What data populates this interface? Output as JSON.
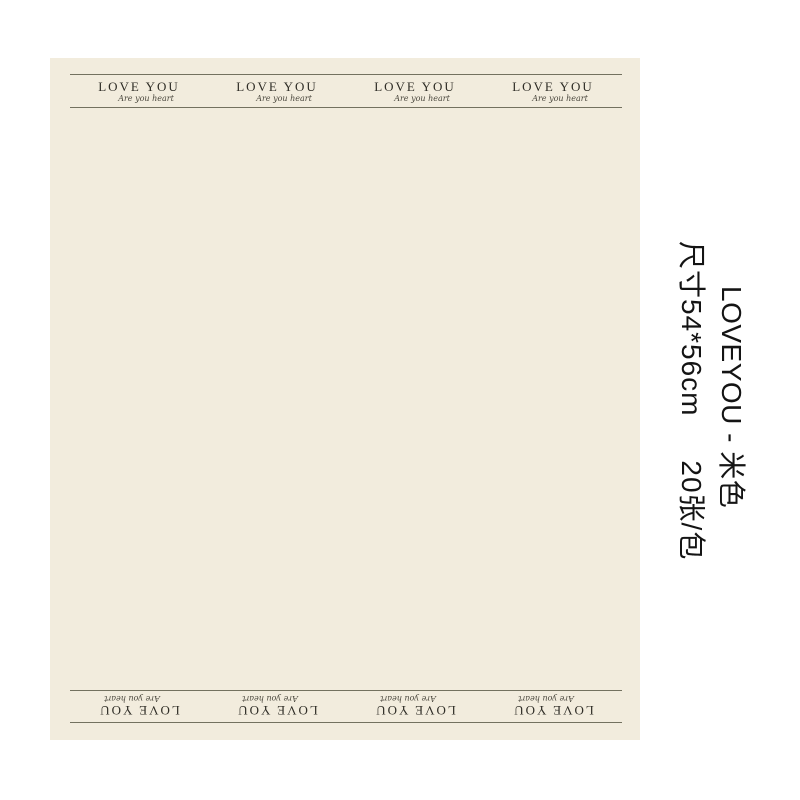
{
  "colors": {
    "paper": "#f2ecdd",
    "line": "#73715f",
    "logo-text": "#2f2d26",
    "script-text": "#4a473d",
    "caption-text": "#141414",
    "page-bg": "#ffffff"
  },
  "paper": {
    "logo": {
      "title": "LOVE YOU",
      "script": "Are you heart"
    },
    "repeat_count_top": 4,
    "repeat_count_bottom": 4
  },
  "caption": {
    "title": "LOVEYOU - 米色",
    "spec": "尺寸54*56cm     20张/包"
  }
}
